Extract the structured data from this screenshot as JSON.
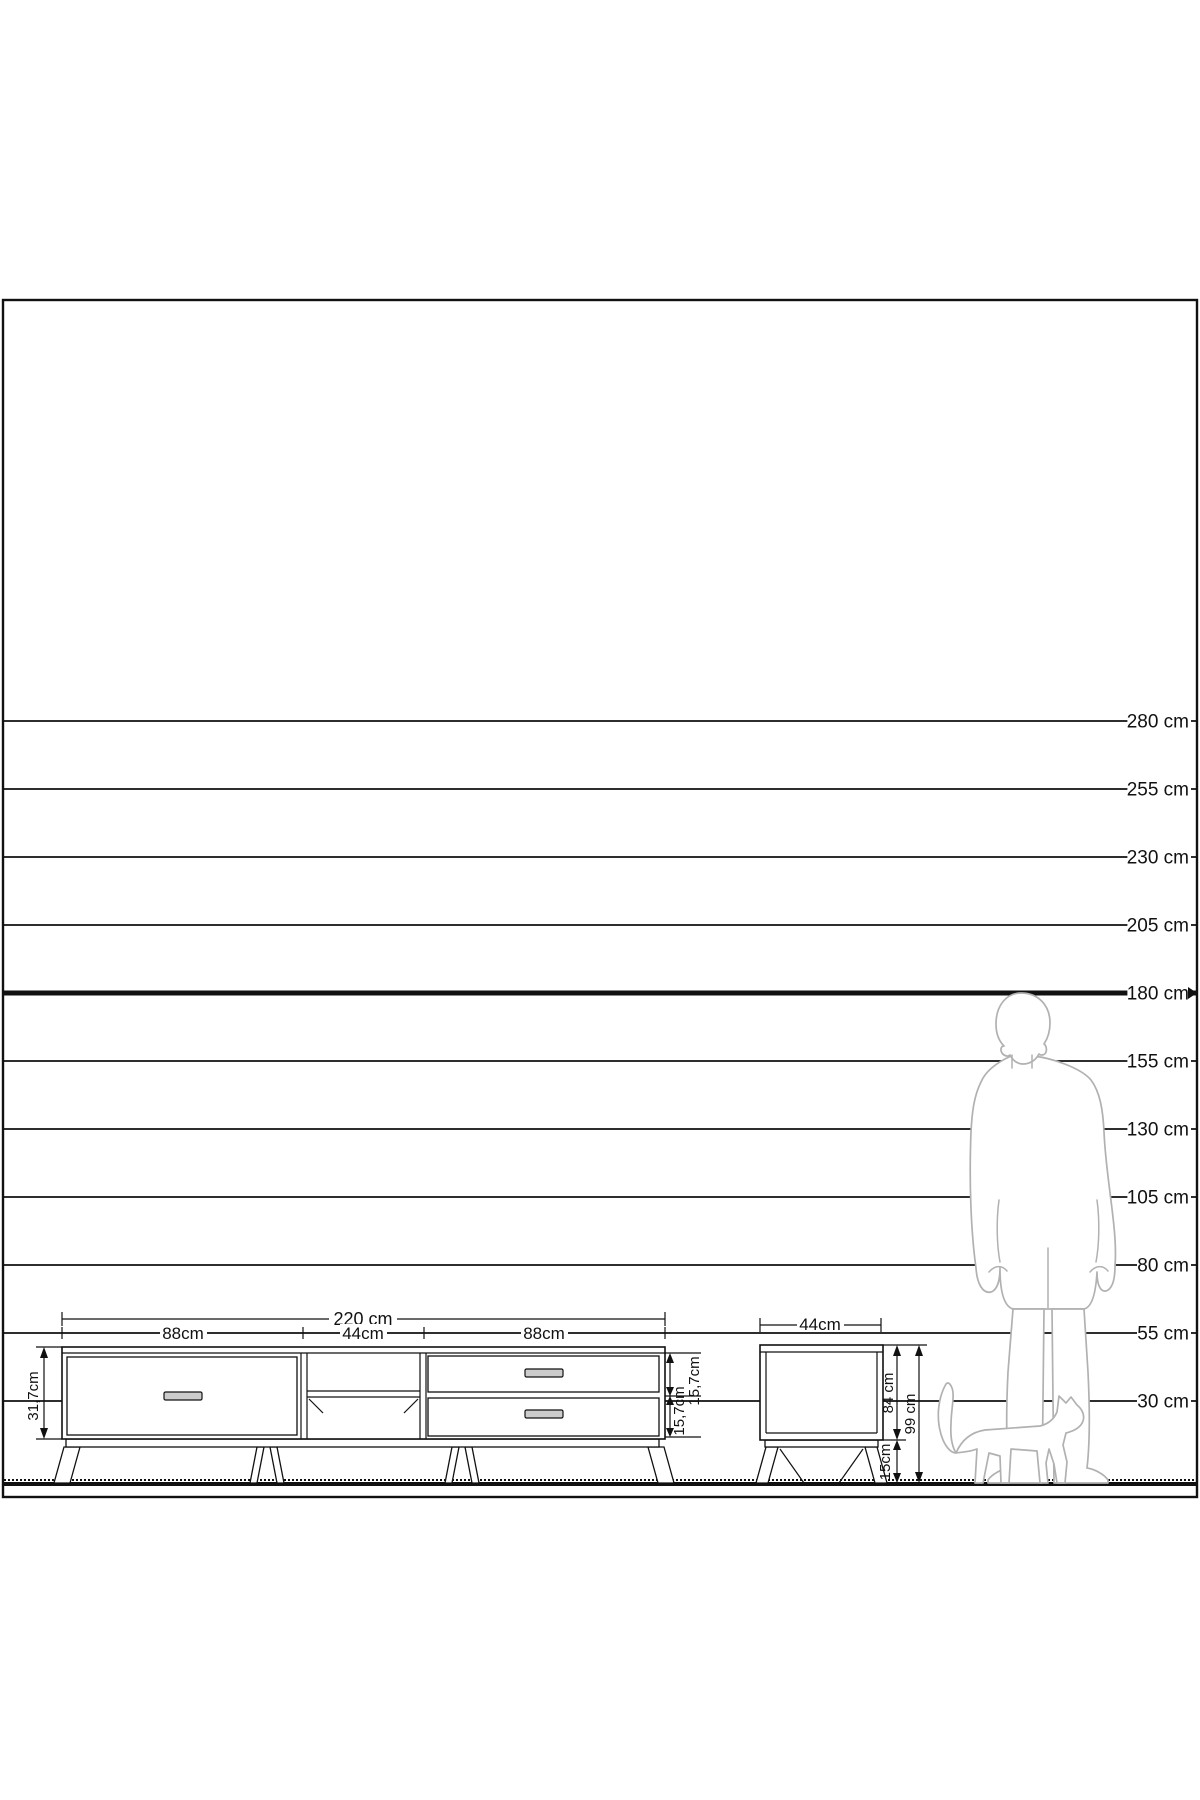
{
  "diagram": {
    "colors": {
      "line": "#111111",
      "figure": "#b1b1b1",
      "handle_fill": "#cccccc",
      "background": "#ffffff"
    },
    "scale_lines": [
      {
        "label": "280 cm",
        "cm": 280,
        "y": 721,
        "bold": false
      },
      {
        "label": "255 cm",
        "cm": 255,
        "y": 789,
        "bold": false
      },
      {
        "label": "230 cm",
        "cm": 230,
        "y": 857,
        "bold": false
      },
      {
        "label": "205 cm",
        "cm": 205,
        "y": 925,
        "bold": false
      },
      {
        "label": "180 cm",
        "cm": 180,
        "y": 993,
        "bold": true
      },
      {
        "label": "155 cm",
        "cm": 155,
        "y": 1061,
        "bold": false
      },
      {
        "label": "130 cm",
        "cm": 130,
        "y": 1129,
        "bold": false
      },
      {
        "label": "105 cm",
        "cm": 105,
        "y": 1197,
        "bold": false
      },
      {
        "label": "80 cm",
        "cm": 80,
        "y": 1265,
        "bold": false
      },
      {
        "label": "55 cm",
        "cm": 55,
        "y": 1333,
        "bold": false
      },
      {
        "label": "30 cm",
        "cm": 30,
        "y": 1401,
        "bold": false
      }
    ],
    "tv_stand": {
      "width_label": "220 cm",
      "section_labels": [
        "88cm",
        "44cm",
        "88cm"
      ],
      "height_label": "31,7cm",
      "drawer_height_labels": [
        "15,7cm",
        "15,7cm"
      ]
    },
    "nightstand": {
      "width_label": "44cm",
      "body_height_label": "84 cm",
      "total_height_label": "99 cm",
      "leg_height_label": "15cm"
    },
    "figures": {
      "person": "man-silhouette-180cm",
      "animal": "cat-silhouette"
    }
  }
}
